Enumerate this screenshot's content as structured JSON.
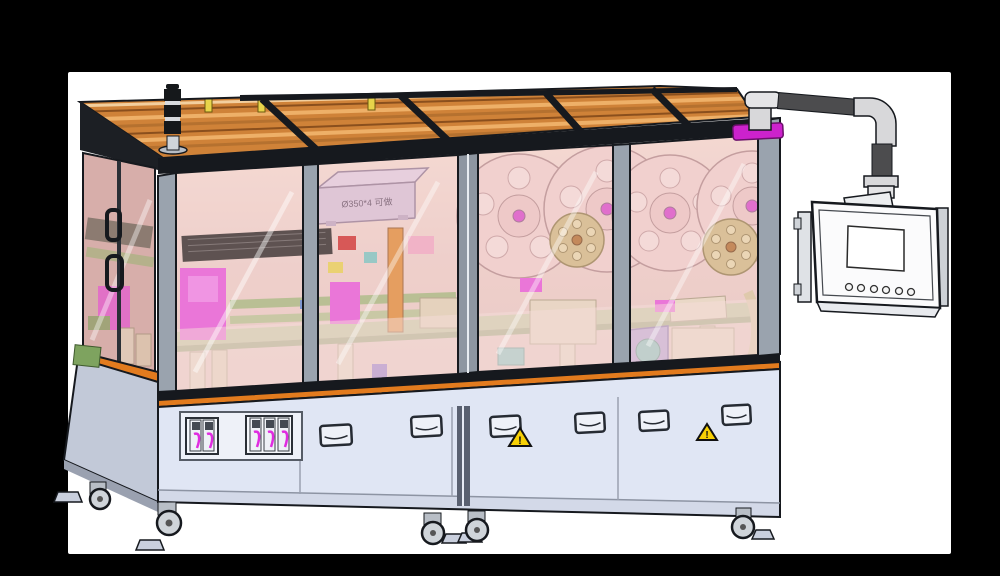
{
  "canvas": {
    "background": "#000000",
    "surface": "#ffffff"
  },
  "annotations": {
    "carton_label": "Ø350*4 可做",
    "warning_glyph": "!"
  },
  "palette": {
    "roof_orange": "#cf8238",
    "roof_slat_light": "#eeb068",
    "roof_slat_dark": "#8a4f1d",
    "frame_dark": "#16191e",
    "post_gray": "#9aa3ae",
    "glass_pink": "#eccfcb",
    "glass_side_pink": "#d8b5b1",
    "interior_salmon": "#f6ded6",
    "cabinet_blue": "#e0e6f4",
    "cabinet_side_blue": "#c2c9d8",
    "table_orange": "#e27b1e",
    "machinery_green": "#b7c896",
    "machinery_magenta": "#e84fe0",
    "machinery_tan": "#e2d8bd",
    "reel_pink": "#f2d3d2",
    "reel_hub_magenta": "#d944cf",
    "reel_khaki": "#d0bb83",
    "teal": "#6fc7c4",
    "purple_motor": "#a393dd",
    "carton_lavender": "#d8c4de",
    "warning_yellow": "#f7d005",
    "hmi_white": "#fbfbfc",
    "arm_dark": "#4c4c4e",
    "arm_silver": "#d8d8da",
    "hmi_mount_magenta": "#cc22cc"
  },
  "machine": {
    "front_window_count": 4,
    "large_reel_count": 4,
    "small_reel_count": 2,
    "signal_tower_segment_count": 3
  },
  "cabinet": {
    "door_handle_count": 6,
    "warning_label_count": 2,
    "connector_panels": [
      {
        "module_count": 2
      },
      {
        "module_count": 3
      }
    ]
  },
  "hmi": {
    "button_count": 6,
    "screen_state": "blank"
  }
}
